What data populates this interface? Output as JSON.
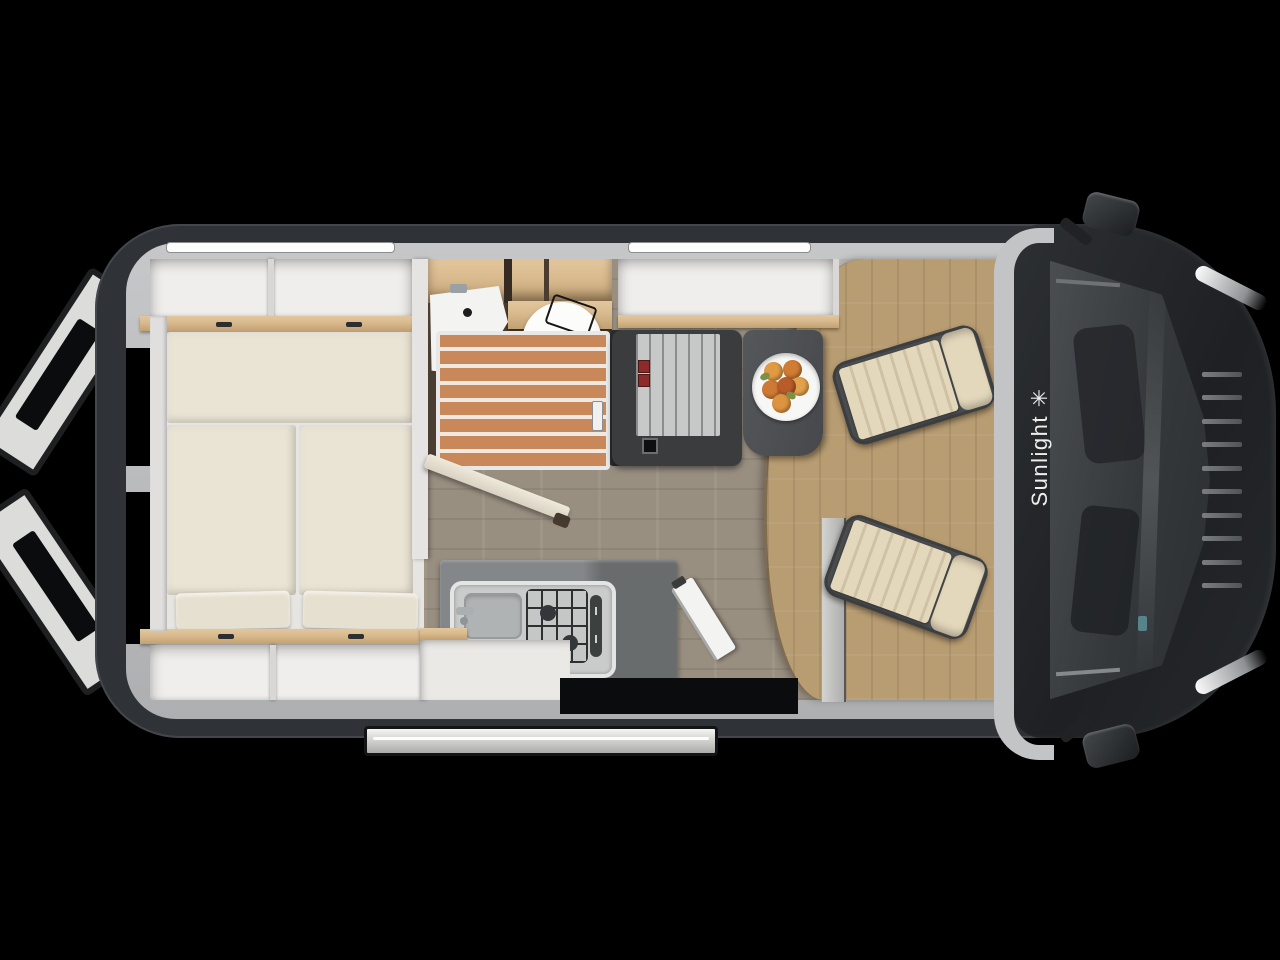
{
  "brand": {
    "name": "Sunlight",
    "logo_glyph": "✳"
  },
  "colors": {
    "bg": "#000000",
    "body_dark": "#2f3236",
    "hood_dark": "#232528",
    "wall_light": "#b9babc",
    "interior_white": "#e7e5e1",
    "cabinet_white": "#efeeec",
    "wood": "#d8ba8e",
    "wood_dark": "#c2a072",
    "mattress": "#eae4d4",
    "floor_living": "#998f81",
    "floor_cab": "#b89c72",
    "shower_wood": "#c8885a",
    "porcelain": "#f3f3f1",
    "counter": "#848789",
    "counter_dark": "#696c6d",
    "steel": "#c9cccb",
    "bench_dark": "#3a3c3e",
    "bench_rib": "#c7c9c8",
    "belt_red": "#8d2b2b",
    "table_dark": "#4f5254",
    "seat_cushion": "#e4d8bc",
    "seat_stripe": "#cfc2a4",
    "seat_frame": "#4a4c4e",
    "band": "#c3c4c6",
    "glass": "#383c3f",
    "plate": "#f7f7f5",
    "fruit_leaf": "#7e9048",
    "step": "#e6e6e5",
    "door_white": "#dcdcda",
    "pit_black": "#0b0c0d"
  }
}
